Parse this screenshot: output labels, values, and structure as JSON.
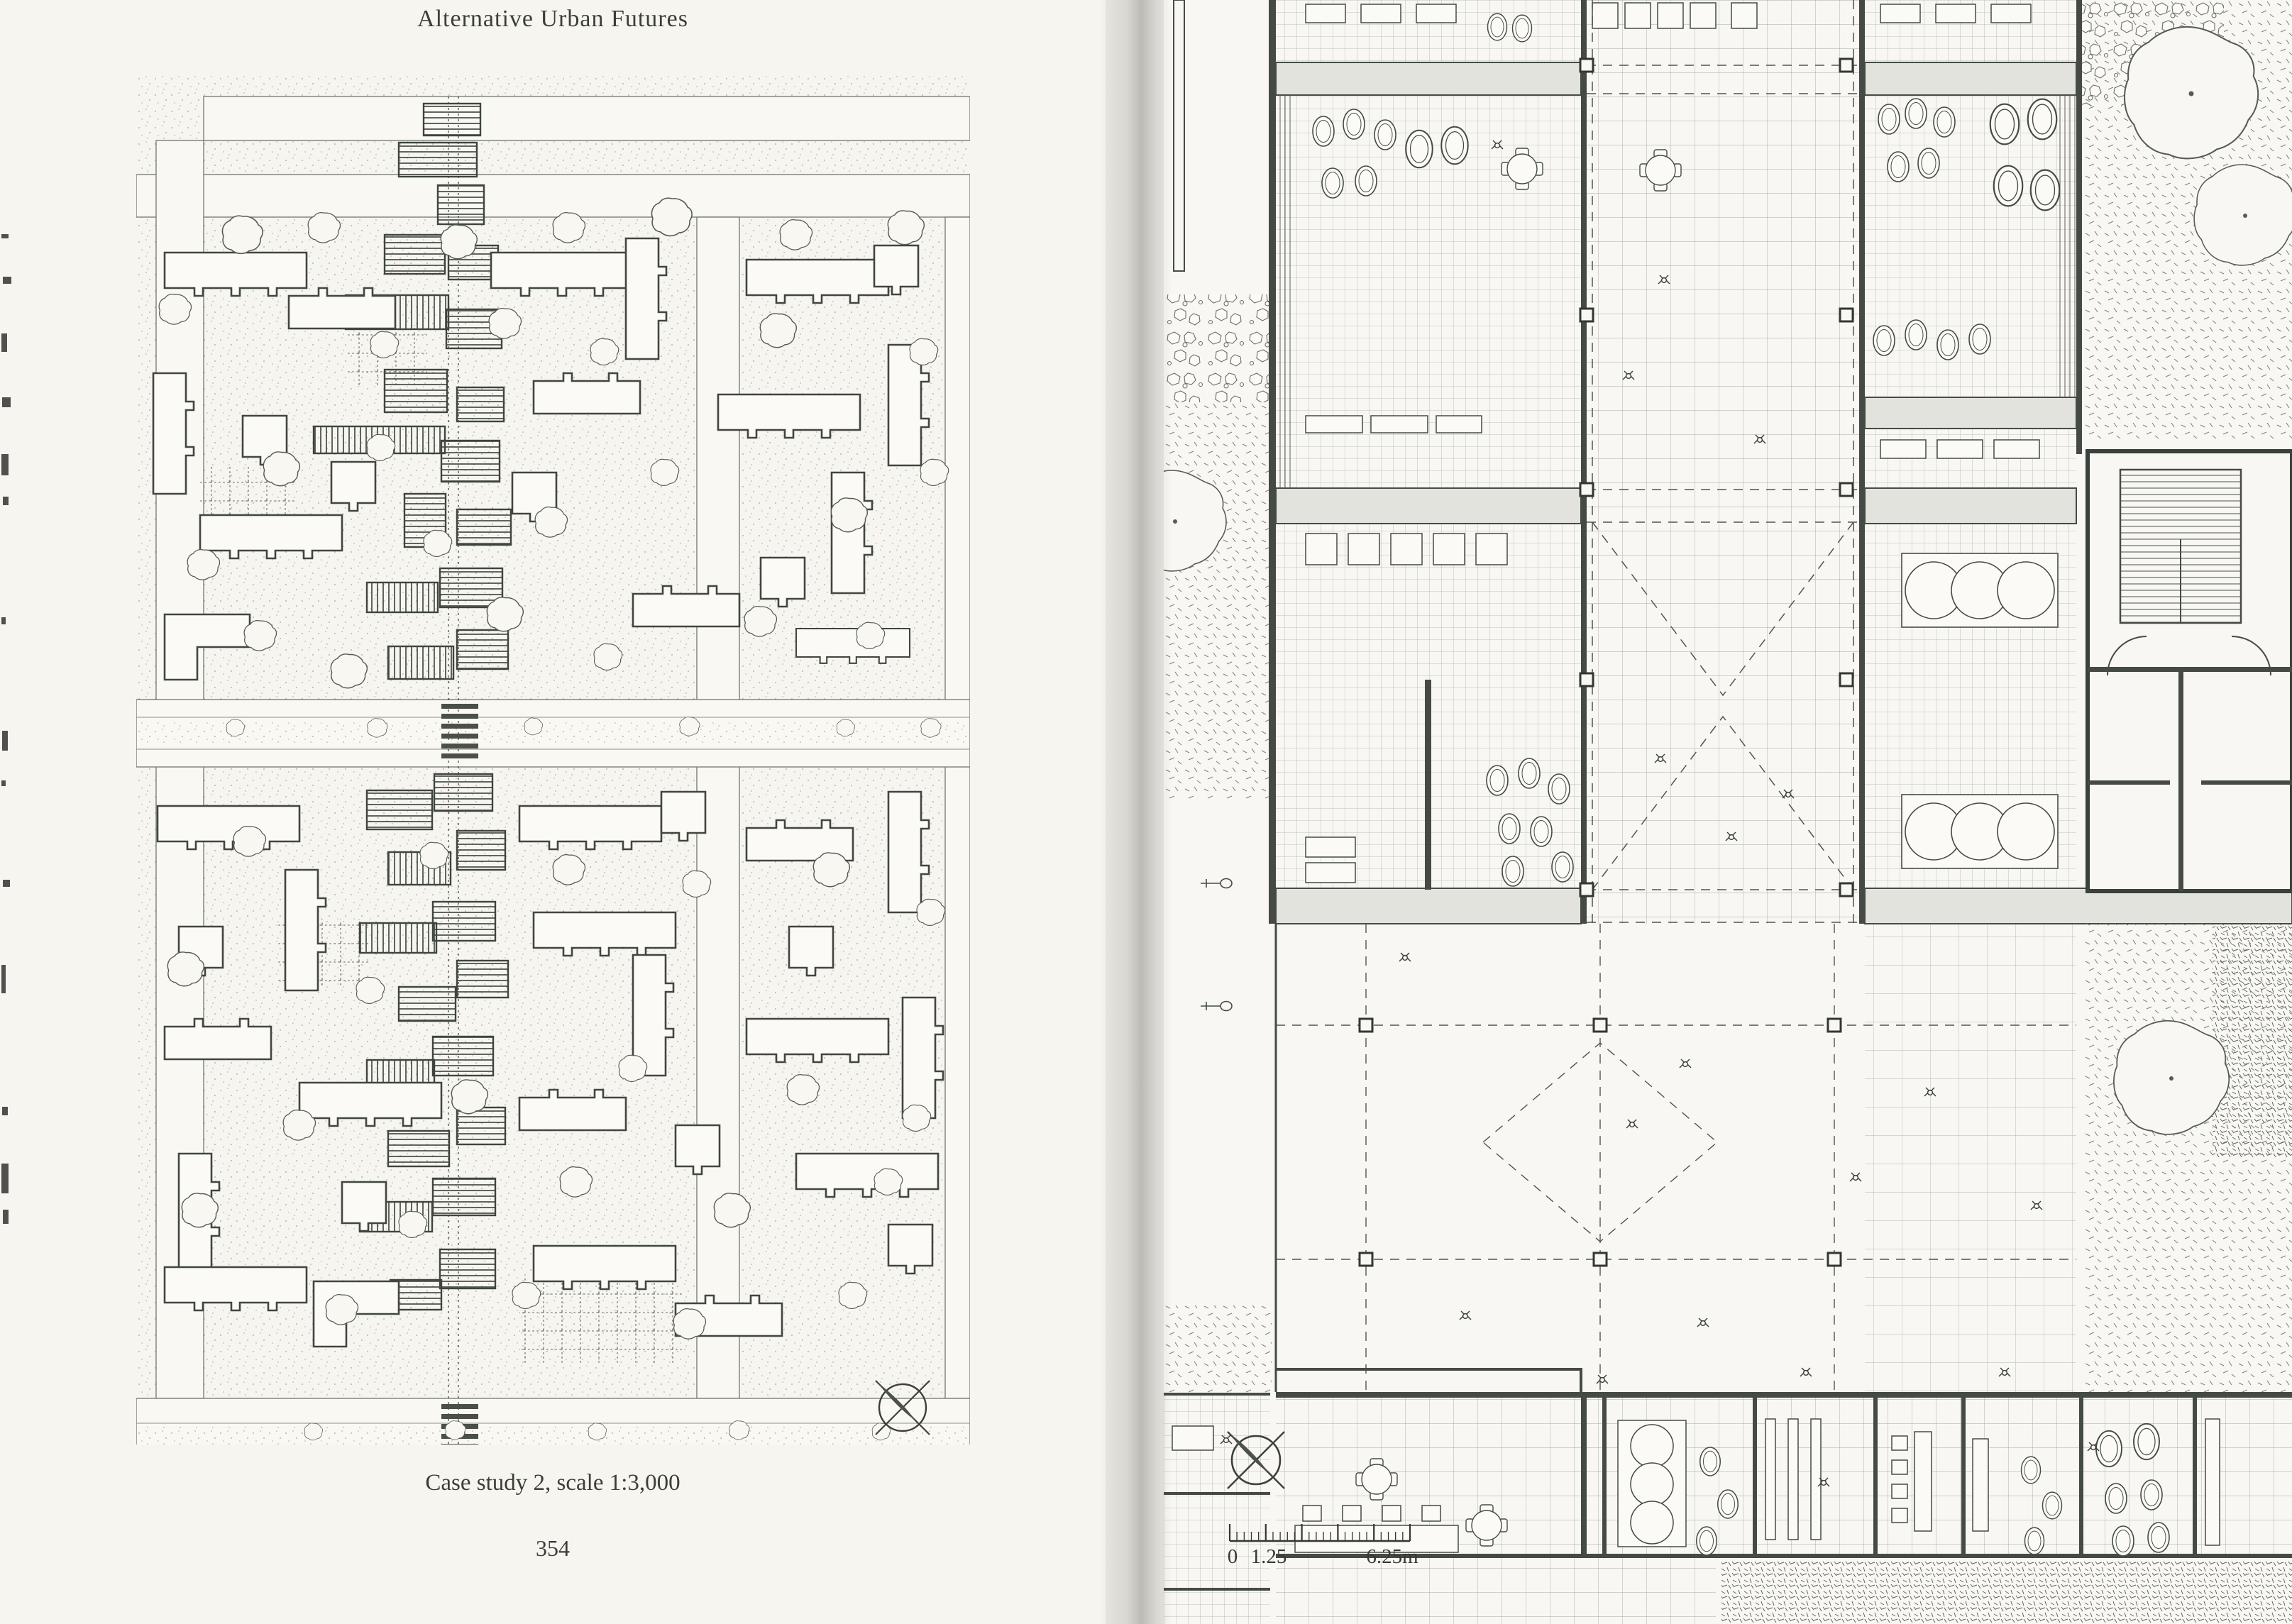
{
  "page_left": {
    "running_head": "Alternative Urban Futures",
    "caption": "Case study 2, scale 1:3,000",
    "page_number": "354"
  },
  "page_right": {
    "scale_bar": {
      "zero": "0",
      "first_division": "1.25",
      "end": "6.25m"
    }
  },
  "icons": {
    "compass_left": "north-compass-icon",
    "compass_right": "north-compass-icon",
    "scale_ruler": "graphic-scale-ruler"
  },
  "colors": {
    "paper_left": "#f6f5f0",
    "paper_right": "#f8f7f3",
    "ink": "#41463f",
    "wall": "#454b44",
    "wall_fill": "#e3e3dd",
    "grid_line": "#6f746b",
    "stipple": "#a0a599"
  }
}
